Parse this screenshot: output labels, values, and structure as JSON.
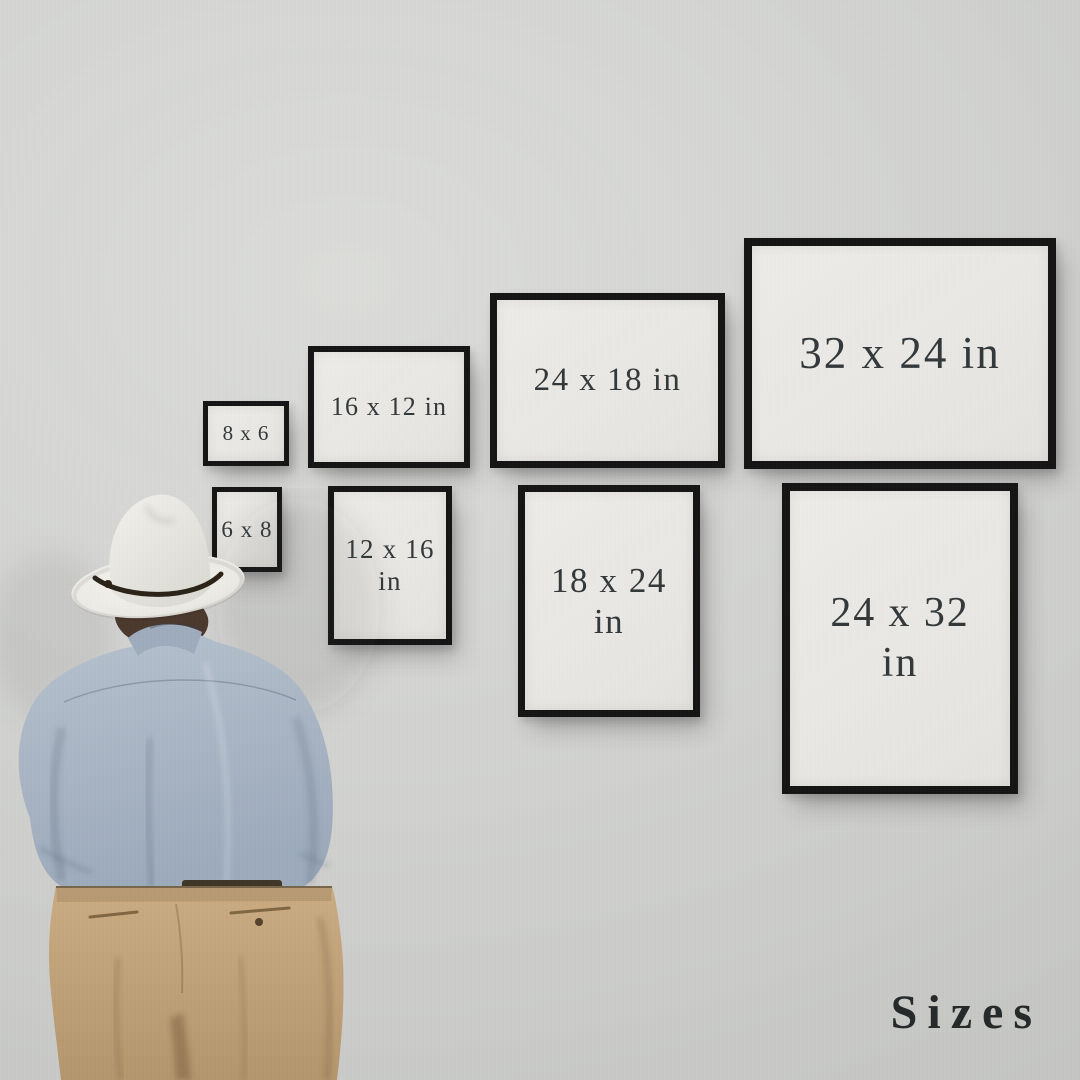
{
  "watermark": {
    "text": "Sizes",
    "color": "#26292a"
  },
  "frames": [
    {
      "id": "frame-8x6",
      "line1": "8 x 6",
      "line2": ""
    },
    {
      "id": "frame-16x12",
      "line1": "16 x 12 in",
      "line2": ""
    },
    {
      "id": "frame-24x18",
      "line1": "24 x 18 in",
      "line2": ""
    },
    {
      "id": "frame-32x24",
      "line1": "32 x 24 in",
      "line2": ""
    },
    {
      "id": "frame-6x8",
      "line1": "6 x 8",
      "line2": ""
    },
    {
      "id": "frame-12x16",
      "line1": "12 x 16",
      "line2": "in"
    },
    {
      "id": "frame-18x24",
      "line1": "18 x 24",
      "line2": "in"
    },
    {
      "id": "frame-24x32",
      "line1": "24 x 32",
      "line2": "in"
    }
  ],
  "colors": {
    "wall": "#d3d4d2",
    "frame_border": "#151515",
    "frame_paper": "#eae9e5",
    "label_text": "#33383a",
    "hat": "#efeee9",
    "hat_band": "#2b2218",
    "hair": "#4c392e",
    "shirt": "#a9b5c4",
    "trousers": "#c3a47c"
  }
}
